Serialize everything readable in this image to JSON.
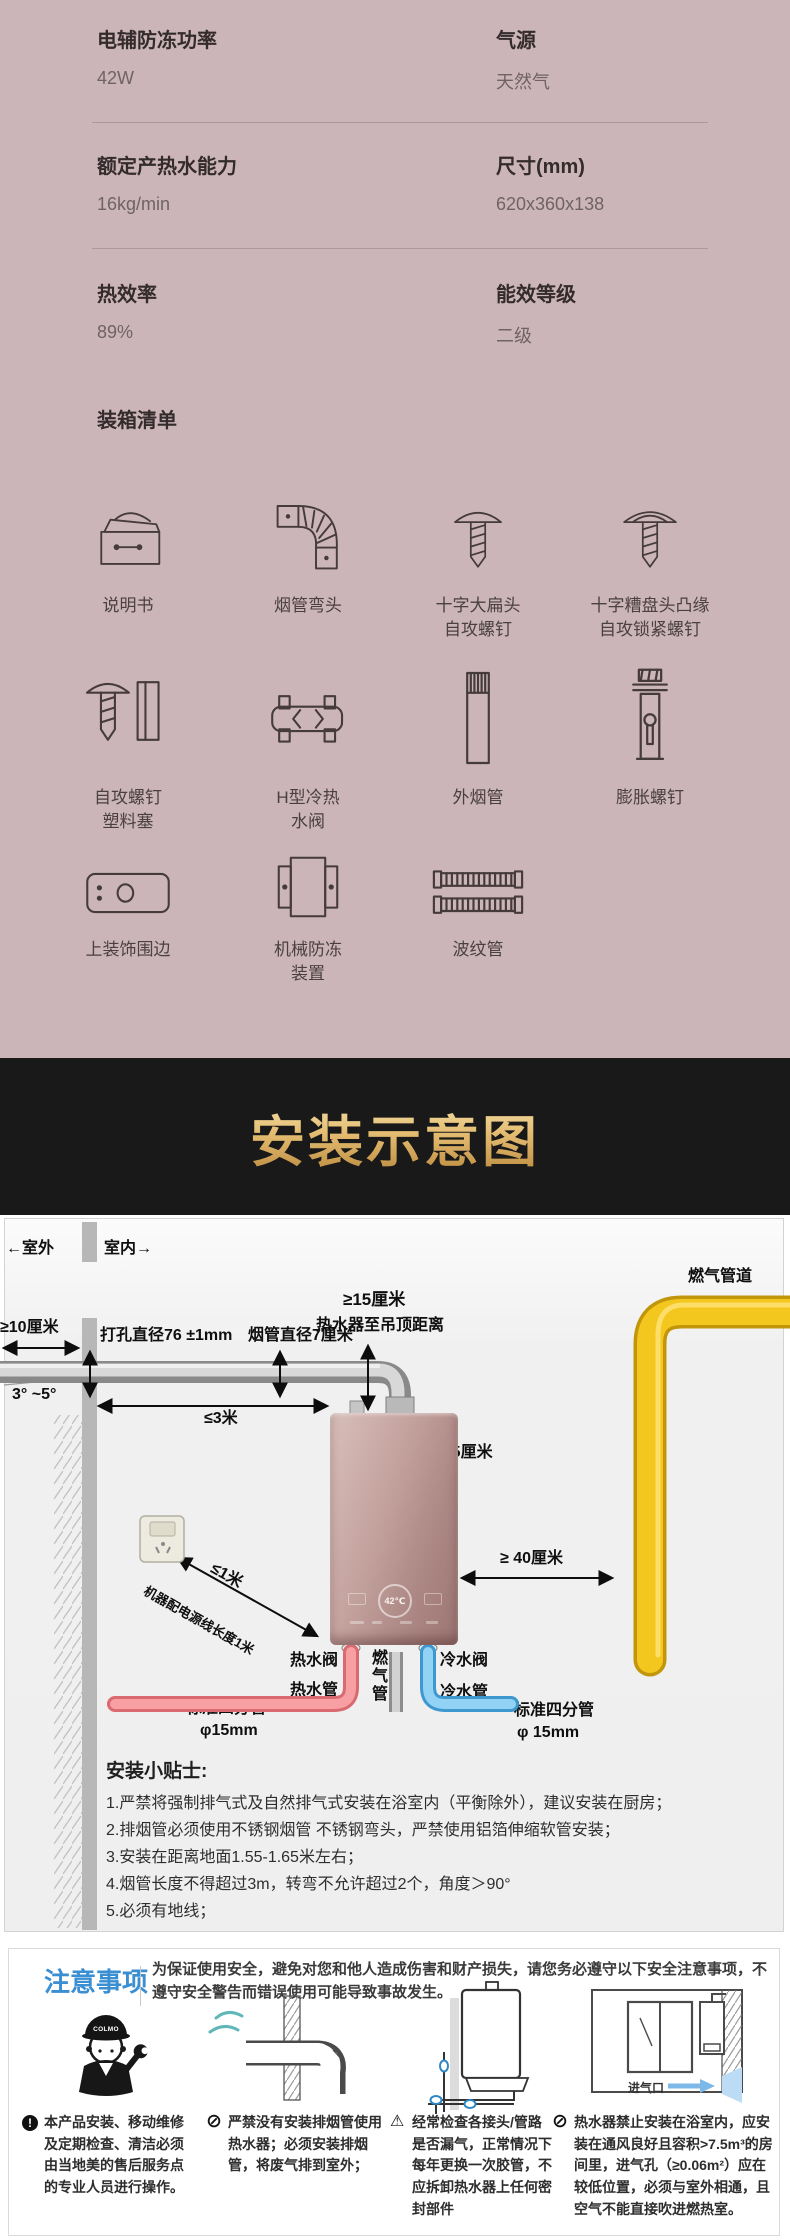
{
  "specs": {
    "rows": [
      {
        "left": {
          "label": "电辅防冻功率",
          "value": "42W"
        },
        "right": {
          "label": "气源",
          "value": "天然气"
        }
      },
      {
        "left": {
          "label": "额定产热水能力",
          "value": "16kg/min"
        },
        "right": {
          "label": "尺寸(mm)",
          "value": "620x360x138"
        }
      },
      {
        "left": {
          "label": "热效率",
          "value": "89%"
        },
        "right": {
          "label": "能效等级",
          "value": "二级"
        }
      }
    ],
    "packing_title": "装箱清单",
    "packing_items": [
      {
        "label": "说明书"
      },
      {
        "label": "烟管弯头"
      },
      {
        "label": "十字大扁头\n自攻螺钉"
      },
      {
        "label": "十字糟盘头凸缘\n自攻锁紧螺钉"
      },
      {
        "label": "自攻螺钉\n塑料塞"
      },
      {
        "label": "H型冷热\n水阀"
      },
      {
        "label": "外烟管"
      },
      {
        "label": "膨胀螺钉"
      },
      {
        "label": "上装饰围边"
      },
      {
        "label": "机械防冻\n装置"
      },
      {
        "label": "波纹管"
      }
    ]
  },
  "banner": {
    "title": "安装示意图"
  },
  "diagram": {
    "outdoor": "←室外",
    "indoor": "室内→",
    "gas_line": "燃气管道",
    "ceiling_dist": "≥15厘米",
    "ceiling_note": "热水器至吊顶距离",
    "out_dist": "≥10厘米",
    "hole_dia": "打孔直径76 ±1mm",
    "flue_dia": "烟管直径7厘米",
    "angle": "3°  ~5°",
    "len3m": "≤3米",
    "dist25": "≥25厘米",
    "dist40": "≥ 40厘米",
    "len1m": "≤1米",
    "power_note": "机器配电源线长度1米",
    "hot_valve": "热水阀",
    "gas_tube": "燃\n气\n管",
    "cold_valve": "冷水阀",
    "hot_pipe": "热水管",
    "cold_pipe": "冷水管",
    "std_left1": "标准四分管",
    "std_left2": "φ15mm",
    "std_right1": "标准四分管",
    "std_right2": "φ 15mm",
    "heater_temp": "42℃",
    "tips_title": "安装小贴士:",
    "tips": [
      "1.严禁将强制排气式及自然排气式安装在浴室内（平衡除外），建议安装在厨房；",
      "2.排烟管必须使用不锈钢烟管 不锈钢弯头，严禁使用铝箔伸缩软管安装；",
      "3.安装在距离地面1.55-1.65米左右；",
      "4.烟管长度不得超过3m，转弯不允许超过2个，角度＞90°",
      "5.必须有地线；"
    ]
  },
  "notice": {
    "title": "注意事项",
    "intro": "为保证使用安全，避免对您和他人造成伤害和财产损失，请您务必遵守以下安全注意事项，不遵守安全警告而错误使用可能导致事故发生。",
    "mascot_brand": "COLMO",
    "air_inlet": "进气口",
    "items": [
      {
        "glyph": "!",
        "text": "本产品安装、移动维修及定期检查、清洁必须由当地美的售后服务点的专业人员进行操作。"
      },
      {
        "glyph": "⊘",
        "text": "严禁没有安装排烟管使用热水器；必须安装排烟管，将废气排到室外；"
      },
      {
        "glyph": "⚠",
        "text": "经常检查各接头/管路是否漏气，正常情况下每年更换一次胶管，不应拆卸热水器上任何密封部件"
      },
      {
        "glyph": "⊘",
        "text": "热水器禁止安装在浴室内，应安装在通风良好且容积>7.5m³的房间里，进气孔（≥0.06m²）应在较低位置，必须与室外相通，且空气不能直接吹进燃热室。"
      }
    ]
  },
  "colors": {
    "spec_bg": "#cbb5b8",
    "banner_bg": "#191919",
    "gold": "#e4bd72",
    "notice_blue": "#3a8ed2",
    "gas_yellow": "#f4c71e",
    "hot_red": "#f79fa3",
    "cold_blue": "#92d2f4"
  }
}
